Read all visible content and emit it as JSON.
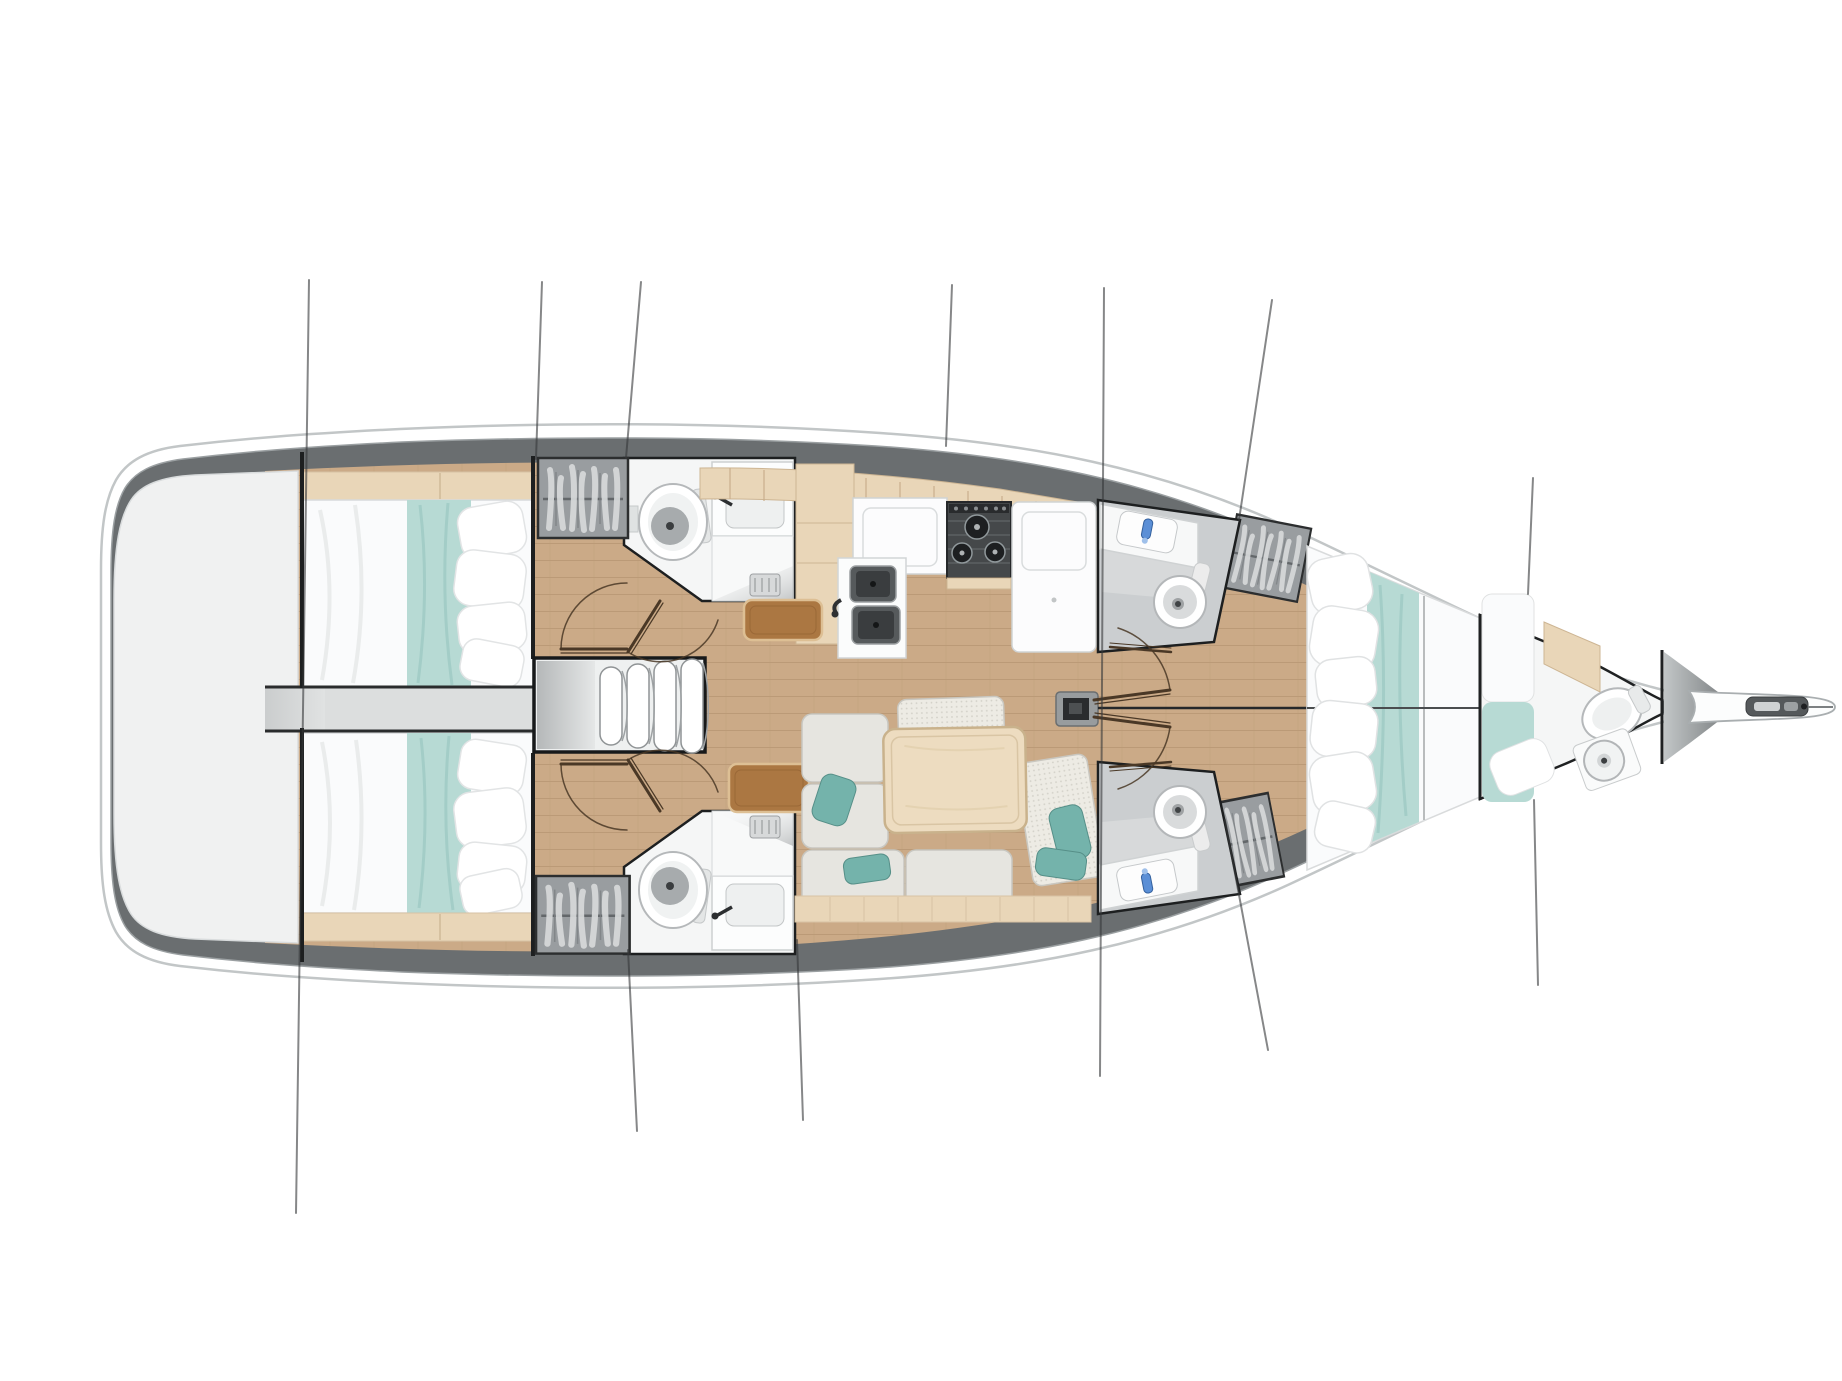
{
  "meta": {
    "title": "Sailing yacht interior layout plan",
    "view": "top-down deck plan, bow to the right, stern to the left",
    "vessel_type": "monohull sailing yacht"
  },
  "rooms": [
    {
      "id": "swim-platform",
      "label": "Stern swim platform / transom locker"
    },
    {
      "id": "aft-cabin-port",
      "label": "Aft double cabin, port"
    },
    {
      "id": "aft-cabin-starboard",
      "label": "Aft double cabin, starboard"
    },
    {
      "id": "engine-passage",
      "label": "Passage / engine access between aft cabins"
    },
    {
      "id": "companionway",
      "label": "Companionway stairs (4 treads)"
    },
    {
      "id": "head-aft-port",
      "label": "Head with shower, aft port"
    },
    {
      "id": "head-aft-starboard",
      "label": "Head with shower, aft starboard"
    },
    {
      "id": "galley",
      "label": "L-shaped galley"
    },
    {
      "id": "saloon",
      "label": "Saloon with L-sofa, benches and table"
    },
    {
      "id": "head-fwd-port",
      "label": "Forward head, port side"
    },
    {
      "id": "head-fwd-starboard",
      "label": "Forward head, starboard side"
    },
    {
      "id": "forward-cabin",
      "label": "Forward owner's cabin, split double berth"
    },
    {
      "id": "bow-berth",
      "label": "Forepeak berth with private head"
    },
    {
      "id": "anchor-locker",
      "label": "Anchor locker"
    },
    {
      "id": "bowsprit",
      "label": "Bowsprit with anchor roller"
    }
  ],
  "fixtures": {
    "toilets": 5,
    "washbasins": 5,
    "galley_sinks": 2,
    "stove_burners": 3,
    "wardrobes": 4,
    "companionway_steps": 4,
    "double_berths": 3,
    "door_swings": 6,
    "rigging_lines": 11,
    "mast_steps": 1,
    "saloon_tables": 1
  },
  "colors": {
    "hull": "#ffffff",
    "hull_stroke": "#c2c6c7",
    "deck": "#6a6e70",
    "floor": "#cbaa87",
    "platform": "#f0f1f1",
    "walkway": "#dcdede",
    "bedding": "#fafbfc",
    "teal": "#b7dad4",
    "teal_pillow": "#74b3ab",
    "wood": "#e9d6b8",
    "table_wood": "#eddcc0",
    "cabinet_brown": "#ab7742",
    "head_white": "#f5f6f6",
    "head_gray": "#cbced0",
    "wardrobe": "#999da0",
    "cushion": "#e6e5e0",
    "stairs": "#eef0f0",
    "stove": "#45484a",
    "steel": "#565a5c",
    "faucet_blue": "#5b8fd6",
    "stay": "#36383a",
    "door": "#4a3826"
  }
}
